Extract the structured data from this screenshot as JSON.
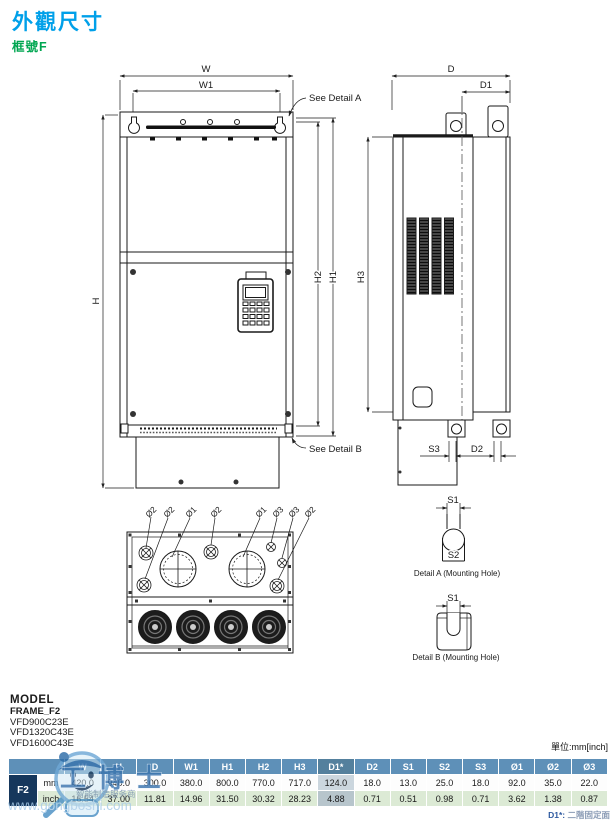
{
  "header": {
    "title": "外觀尺寸",
    "subtitle": "框號F",
    "title_color": "#00A0E9",
    "subtitle_color": "#00A651"
  },
  "drawing": {
    "dims": {
      "W": "W",
      "W1": "W1",
      "H": "H",
      "H1": "H1",
      "H2": "H2",
      "H3": "H3",
      "D": "D",
      "D1": "D1",
      "D2": "D2",
      "S1": "S1",
      "S2": "S2",
      "S3": "S3"
    },
    "see_detail_a": "See Detail A",
    "see_detail_b": "See Detail B",
    "detail_a_caption": "Detail A (Mounting Hole)",
    "detail_b_caption": "Detail B (Mounting Hole)",
    "hole_labels": [
      "Ø2",
      "Ø2",
      "Ø1",
      "Ø2",
      "Ø1",
      "Ø3",
      "Ø3",
      "Ø2"
    ]
  },
  "model": {
    "title": "MODEL",
    "frame": "FRAME_F2",
    "items": [
      "VFD900C23E",
      "VFD1320C43E",
      "VFD1600C43E"
    ]
  },
  "table": {
    "unit_label": "單位:mm[inch]",
    "row_label": "F2",
    "unit_rows": [
      "mm",
      "inch"
    ],
    "headers": [
      "W",
      "H",
      "D",
      "W1",
      "H1",
      "H2",
      "H3",
      "D1*",
      "D2",
      "S1",
      "S2",
      "S3",
      "Ø1",
      "Ø2",
      "Ø3"
    ],
    "mm": [
      "420.0",
      "940.0",
      "300.0",
      "380.0",
      "800.0",
      "770.0",
      "717.0",
      "124.0",
      "18.0",
      "13.0",
      "25.0",
      "18.0",
      "92.0",
      "35.0",
      "22.0"
    ],
    "inch": [
      "16.54",
      "37.00",
      "11.81",
      "14.96",
      "31.50",
      "30.32",
      "28.23",
      "4.88",
      "0.71",
      "0.51",
      "0.98",
      "0.71",
      "3.62",
      "1.38",
      "0.87"
    ],
    "note_label": "D1*:",
    "note_text": "二階固定面",
    "colors": {
      "header_bg": "#5E90B8",
      "row_label_bg": "#16375C",
      "inch_row_bg": "#DCEAD5",
      "d1_highlight_mm": "#CBD6DE",
      "d1_highlight_inch": "#B7C5CC"
    }
  },
  "watermark": {
    "brand": "工博士",
    "tagline": "智能制造服务商",
    "url": "www.gongboshi.com",
    "color": "#5B9BD5"
  }
}
